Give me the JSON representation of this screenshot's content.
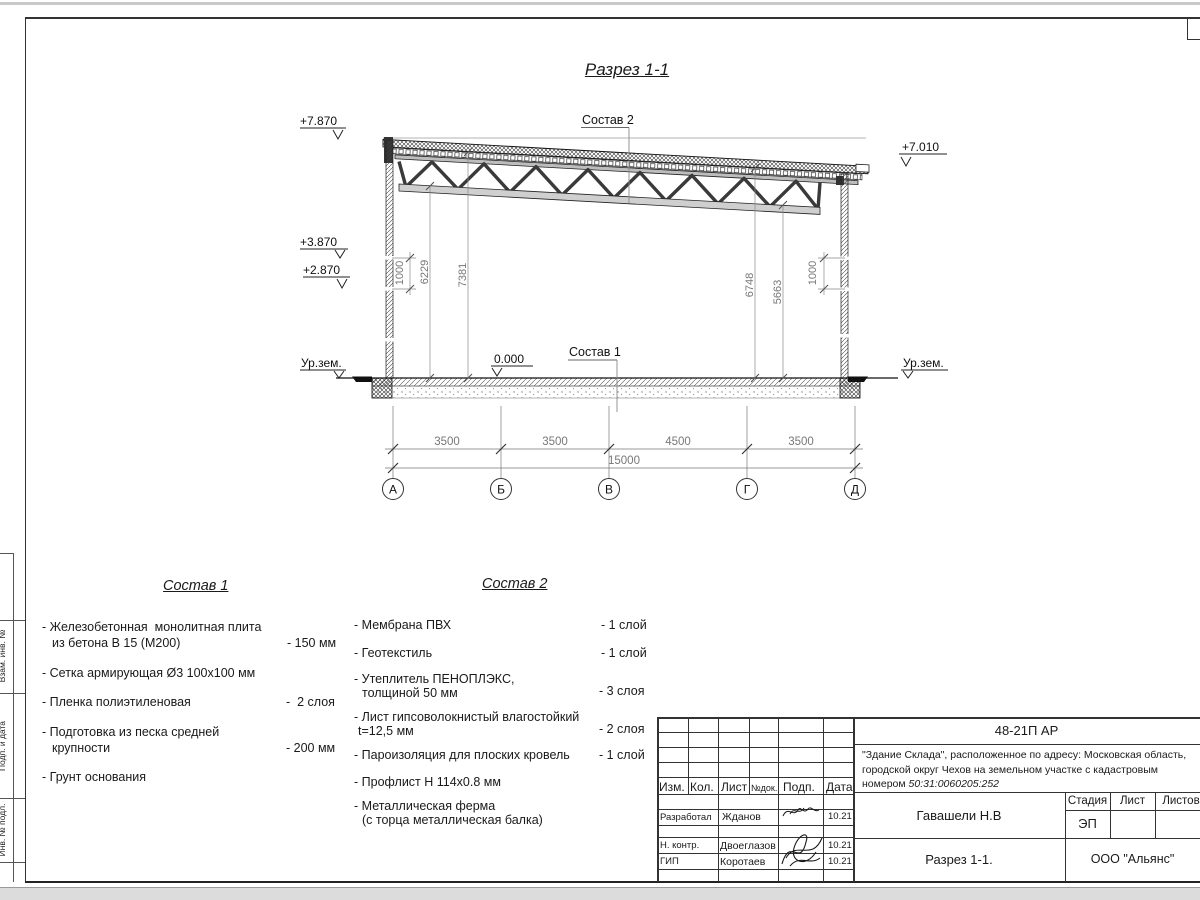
{
  "title": "Разрез 1-1",
  "section": {
    "labels": {
      "sostav1": "Состав 1",
      "sostav2": "Состав 2",
      "ground_left": "Ур.зем.",
      "ground_right": "Ур.зем."
    },
    "elevations": {
      "roof_left": "+7.870",
      "roof_right": "+7.010",
      "wall_top": "+3.870",
      "wall_mid": "+2.870",
      "floor": "0.000"
    },
    "dims": {
      "left_1000": "1000",
      "left_6229": "6229",
      "left_7381": "7381",
      "right_6748": "6748",
      "right_5663": "5663",
      "right_1000": "1000",
      "chain": [
        "3500",
        "3500",
        "4500",
        "3500"
      ],
      "total": "15000"
    },
    "axes": [
      "А",
      "Б",
      "В",
      "Г",
      "Д"
    ]
  },
  "sostav1": {
    "heading": "Состав 1",
    "items": [
      {
        "line1": "- Железобетонная  монолитная плита",
        "line2": "из бетона В 15 (М200)",
        "value": "- 150 мм"
      },
      {
        "line1": "- Сетка армирующая Ø3 100x100 мм",
        "line2": "",
        "value": ""
      },
      {
        "line1": "- Пленка полиэтиленовая",
        "line2": "",
        "value": "-  2 слоя"
      },
      {
        "line1": "- Подготовка из песка средней",
        "line2": "крупности",
        "value": "- 200 мм"
      },
      {
        "line1": "- Грунт основания",
        "line2": "",
        "value": ""
      }
    ]
  },
  "sostav2": {
    "heading": "Состав 2",
    "items": [
      {
        "line1": "- Мембрана ПВХ",
        "line2": "",
        "value": "- 1 слой"
      },
      {
        "line1": "- Геотекстиль",
        "line2": "",
        "value": "- 1 слой"
      },
      {
        "line1": "- Утеплитель ПЕНОПЛЭКС,",
        "line2": "толщиной 50 мм",
        "value": "- 3 слоя"
      },
      {
        "line1": "- Лист гипсоволокнистый влагостойкий",
        "line2": "t=12,5 мм",
        "value": "- 2 слоя"
      },
      {
        "line1": "- Пароизоляция для плоских кровель",
        "line2": "",
        "value": "- 1 слой"
      },
      {
        "line1": "- Профлист Н 114х0.8 мм",
        "line2": "",
        "value": ""
      },
      {
        "line1": "- Металлическая ферма",
        "line2": "(с торца металлическая балка)",
        "value": ""
      }
    ]
  },
  "stamp": {
    "doc_number": "48-21П АР",
    "project_line1": "\"Здание Склада\", расположенное по адресу: Московская область,",
    "project_line2": "городской округ Чехов на земельном участке с кадастровым",
    "project_line3_prefix": "номером ",
    "cadastral": "50:31:0060205:252",
    "cols": {
      "izm": "Изм.",
      "kol": "Кол.",
      "list": "Лист",
      "ndok": "№док.",
      "podp": "Подп.",
      "data": "Дата"
    },
    "rows": [
      {
        "role": "Разработал",
        "name": "Жданов",
        "date": "10.21"
      },
      {
        "role": "Н. контр.",
        "name": "Двоеглазов",
        "date": "10.21"
      },
      {
        "role": "ГИП",
        "name": "Коротаев",
        "date": "10.21"
      }
    ],
    "chief_name": "Гавашели Н.В",
    "stage_label": "Стадия",
    "sheet_label": "Лист",
    "sheets_label": "Листов",
    "stage_value": "ЭП",
    "drawing_name": "Разрез 1-1.",
    "company": "ООО \"Альянс\""
  },
  "frame": {
    "side_label_1": "Взам. инв. №",
    "side_label_2": "Подп. и дата",
    "side_label_3": "Инв. № подл."
  }
}
